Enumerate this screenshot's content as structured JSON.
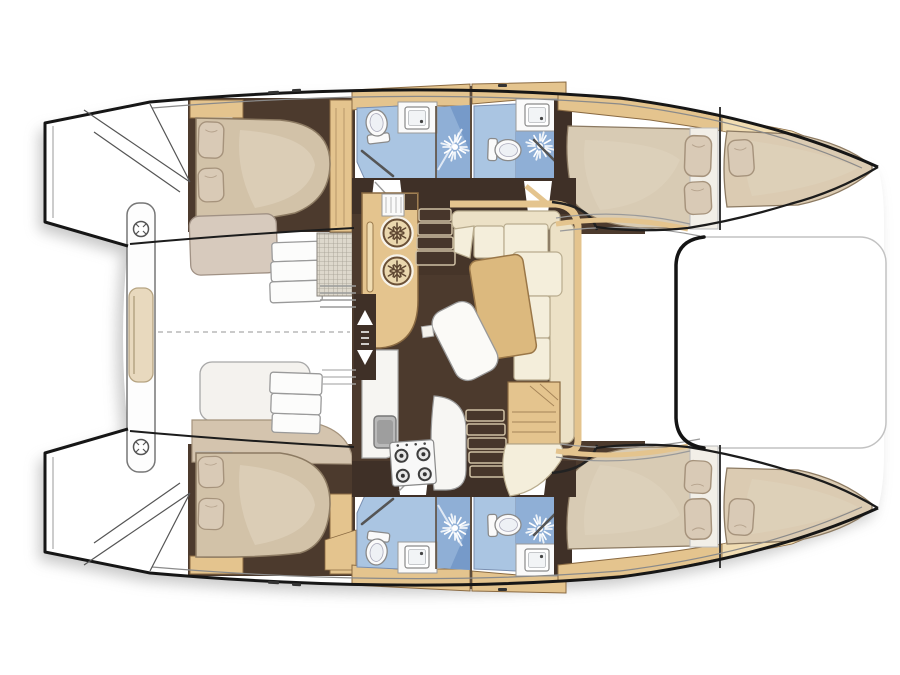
{
  "diagram": {
    "kind": "catamaran-interior-floor-plan",
    "view": "top-down",
    "hull_count": 2,
    "cabin_count": 4,
    "bathroom_count": 4
  },
  "features": {
    "boat": "catamaran hull silhouette, bows to the right",
    "trampoline": "foredeck platform between bows",
    "cockpit": "aft deck between transoms",
    "cockpit_bench": "centre bench with deck hatches and cushion",
    "transom_steps": "transom swim steps",
    "saloon": "central saloon",
    "galley_fridge": "galley unit with two top-loading fridges",
    "galley_stove": "four-burner stove",
    "galley_sink": "galley sink",
    "saloon_table": "saloon table",
    "settee": "U-shaped settee",
    "nav_cabinet": "wood cabinet",
    "stairs_port": "companionway stairs to top hull",
    "stairs_starboard": "companionway stairs to bottom hull",
    "aft_cabin_top": "aft double cabin, top hull",
    "aft_cabin_bottom": "aft double cabin, bottom hull",
    "fwd_cabin_top": "forward double cabin, top hull",
    "fwd_cabin_bottom": "forward double cabin, bottom hull",
    "bow_berth": "forepeak berth",
    "bathroom": "bathroom with toilet, basin and shower",
    "shower": "shower with showerhead symbol",
    "toilet": "marine toilet",
    "basin": "wash basin",
    "bed_pillow": "pillow",
    "deck_hatch": "deck hatch"
  },
  "colors": {
    "outline": "#1a1a1a",
    "hull": "#ffffff",
    "shadow": "#9b9b9b",
    "floor": "#4c3a2d",
    "wall": "#3f3027",
    "wood": "#e4c48e",
    "woodDark": "#8a6a42",
    "woodLight": "#f0dcb2",
    "cream": "#f4eedb",
    "creamDark": "#ece1c6",
    "creamLine": "#b9ac8e",
    "mattress": "#d2c2a8",
    "bedLight": "#ded2bc",
    "sheet": "#f2efe8",
    "pillow": "#d9cab6",
    "pillowLine": "#a6937c",
    "duvet": "#d7cabd",
    "blueLight": "#aac5e2",
    "blueMid": "#8fafd6",
    "blueDark": "#6e93c4",
    "fixture": "#fafafa",
    "grayLine": "#999999",
    "steel": "#a9a9a9",
    "table": "#dcb97e",
    "stair": "#47362b",
    "stairEdge": "#cfc0a4",
    "mat": "#ddd8cc",
    "matLine": "#a39e92",
    "burner": "#3e3e3e",
    "fridgeFace": "#ead7ae"
  }
}
